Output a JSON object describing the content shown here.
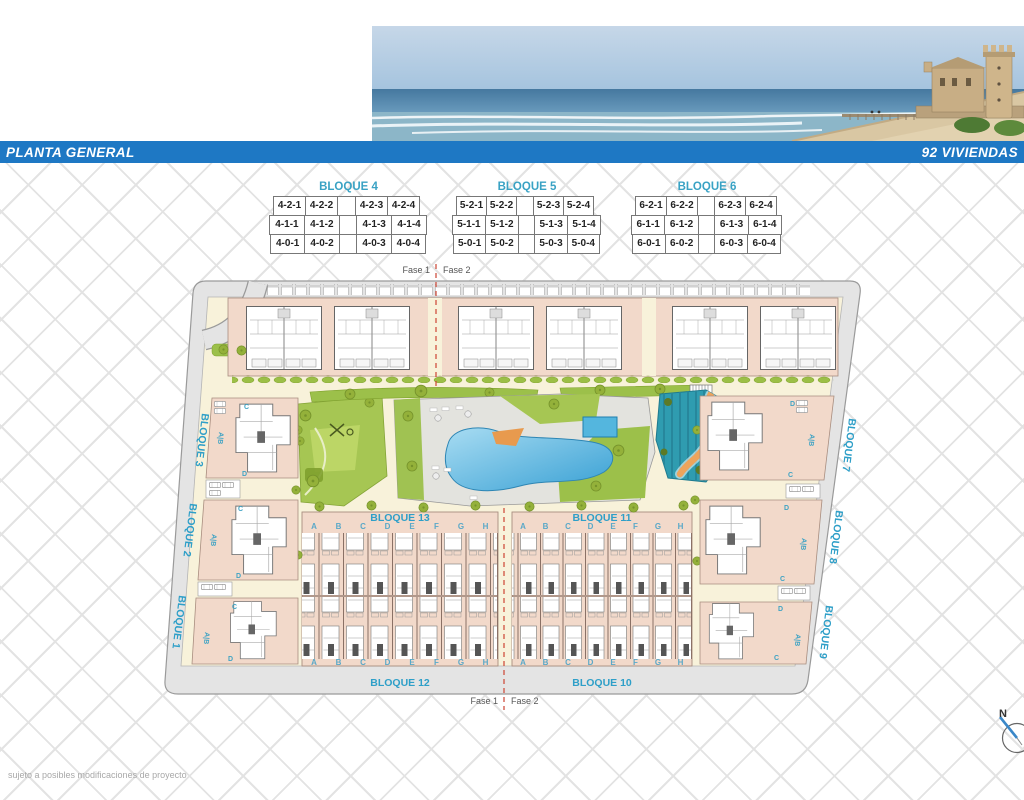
{
  "header": {
    "left": "PLANTA GENERAL",
    "right": "92 VIVIENDAS"
  },
  "tables": [
    {
      "title": "BLOQUE 4",
      "rows": [
        [
          "4-2-1",
          "4-2-2",
          "4-2-3",
          "4-2-4"
        ],
        [
          "4-1-1",
          "4-1-2",
          "4-1-3",
          "4-1-4"
        ],
        [
          "4-0-1",
          "4-0-2",
          "4-0-3",
          "4-0-4"
        ]
      ]
    },
    {
      "title": "BLOQUE 5",
      "rows": [
        [
          "5-2-1",
          "5-2-2",
          "5-2-3",
          "5-2-4"
        ],
        [
          "5-1-1",
          "5-1-2",
          "5-1-3",
          "5-1-4"
        ],
        [
          "5-0-1",
          "5-0-2",
          "5-0-3",
          "5-0-4"
        ]
      ]
    },
    {
      "title": "BLOQUE 6",
      "rows": [
        [
          "6-2-1",
          "6-2-2",
          "6-2-3",
          "6-2-4"
        ],
        [
          "6-1-1",
          "6-1-2",
          "6-1-3",
          "6-1-4"
        ],
        [
          "6-0-1",
          "6-0-2",
          "6-0-3",
          "6-0-4"
        ]
      ]
    }
  ],
  "plan": {
    "fase1": "Fase 1",
    "fase2": "Fase 2",
    "letters": [
      "A",
      "B",
      "C",
      "D",
      "E",
      "F",
      "G",
      "H"
    ],
    "bloques": {
      "b1": "BLOQUE 1",
      "b2": "BLOQUE 2",
      "b3": "BLOQUE 3",
      "b7": "BLOQUE 7",
      "b8": "BLOQUE 8",
      "b9": "BLOQUE 9",
      "b10": "BLOQUE 10",
      "b11": "BLOQUE 11",
      "b12": "BLOQUE 12",
      "b13": "BLOQUE 13"
    },
    "side_labels": {
      "c": "C",
      "ab": "A|B",
      "d": "D"
    }
  },
  "compass": {
    "north": "N"
  },
  "footer": {
    "note": "sujeto a posibles modificaciones de proyecto"
  },
  "colors": {
    "bar_blue": "#1e78c4",
    "label_blue": "#2e9fc8",
    "building_pink": "#f2d9ca",
    "ground_cream": "#f8f2da",
    "road_grey": "#e4e4e4",
    "pool_blue": "#38a0d4",
    "splash_teal": "#2f9cb0",
    "path_orange": "#eda45c",
    "green": "#9cc04a"
  }
}
